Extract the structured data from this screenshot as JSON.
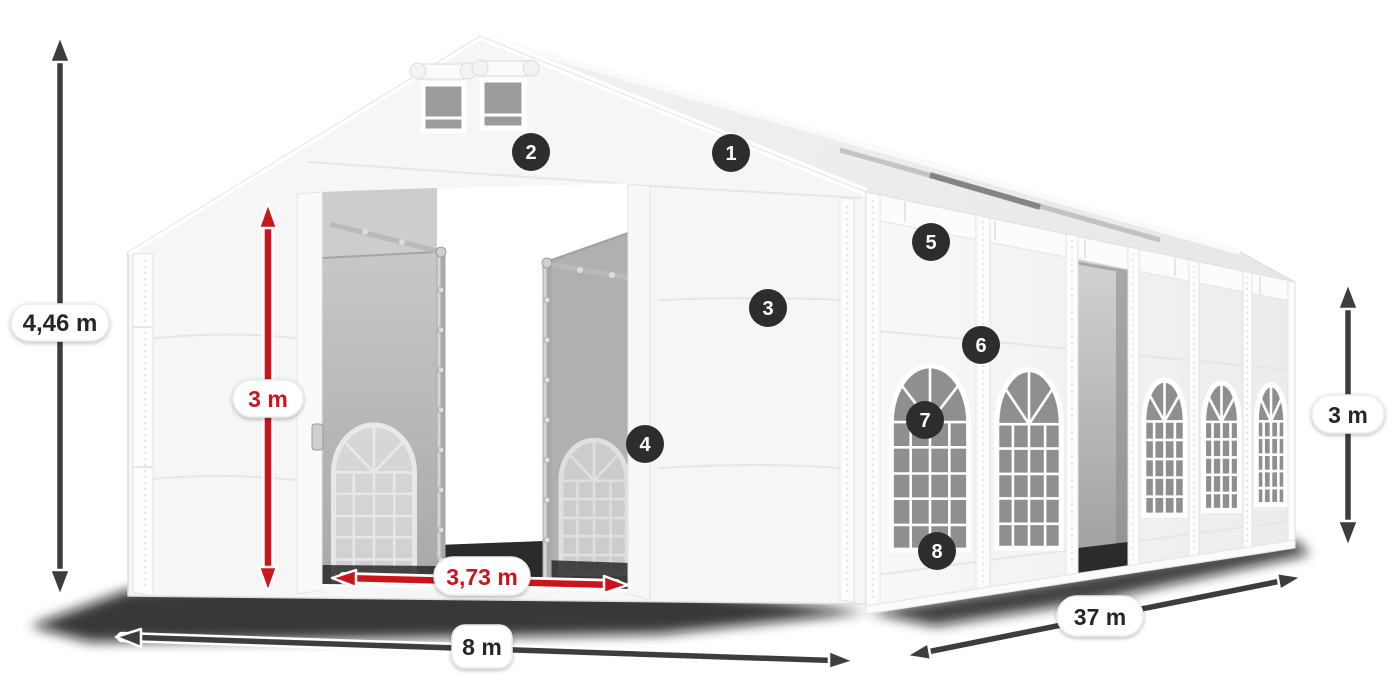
{
  "dimensions": {
    "total_height": "4,46 m",
    "entrance_height": "3 m",
    "entrance_width": "3,73 m",
    "front_width": "8 m",
    "side_length": "37 m",
    "side_wall_height": "3 m"
  },
  "hotspots": [
    {
      "number": "1"
    },
    {
      "number": "2"
    },
    {
      "number": "3"
    },
    {
      "number": "4"
    },
    {
      "number": "5"
    },
    {
      "number": "6"
    },
    {
      "number": "7"
    },
    {
      "number": "8"
    }
  ],
  "colors": {
    "arrow_dark": "#3d3d3d",
    "arrow_red": "#c9151b",
    "hotspot_bg": "#2d2d2d",
    "hotspot_text": "#ffffff",
    "label_text": "#262626"
  }
}
